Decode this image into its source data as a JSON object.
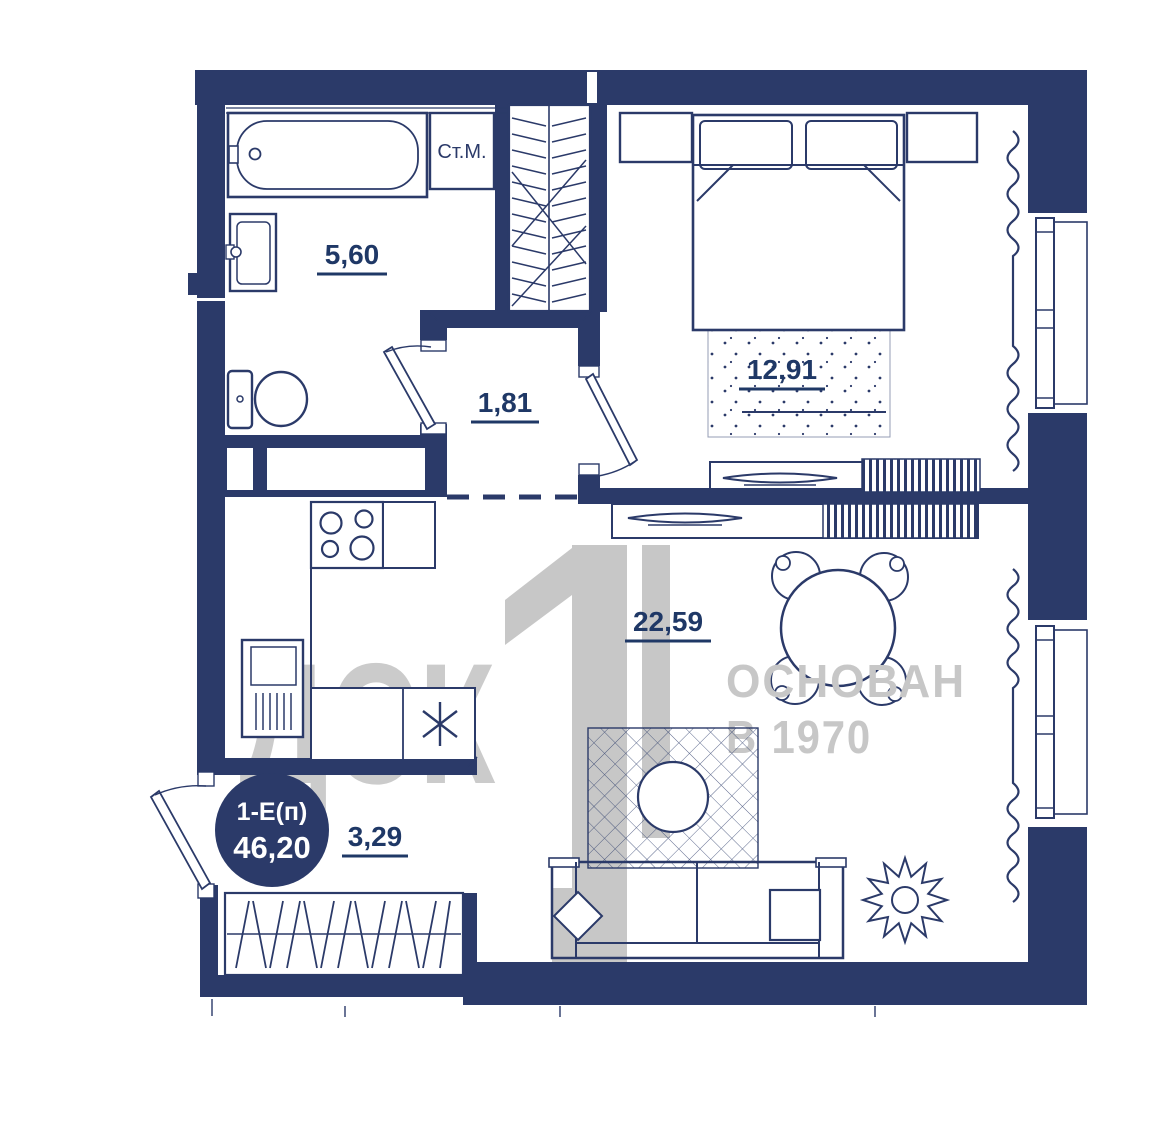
{
  "floor_plan": {
    "unit_badge": {
      "type_label": "1-Е(п)",
      "total_area": "46,20"
    },
    "areas": {
      "bathroom": "5,60",
      "hallway": "1,81",
      "bedroom": "12,91",
      "living_kitchen": "22,59",
      "balcony": "3,29"
    },
    "appliance_labels": {
      "washing_machine": "Ст.М."
    },
    "watermarks": {
      "company": "ДСК",
      "logo_digit": "1",
      "founded_line1": "ОСНОВАН",
      "founded_line2": "В 1970"
    },
    "colors": {
      "walls": "#2b3a69",
      "labels": "#1f3866",
      "watermark_gray": "#c7c7c7",
      "badge_background": "#2b3a69",
      "badge_text": "#ffffff",
      "background": "#ffffff"
    }
  }
}
